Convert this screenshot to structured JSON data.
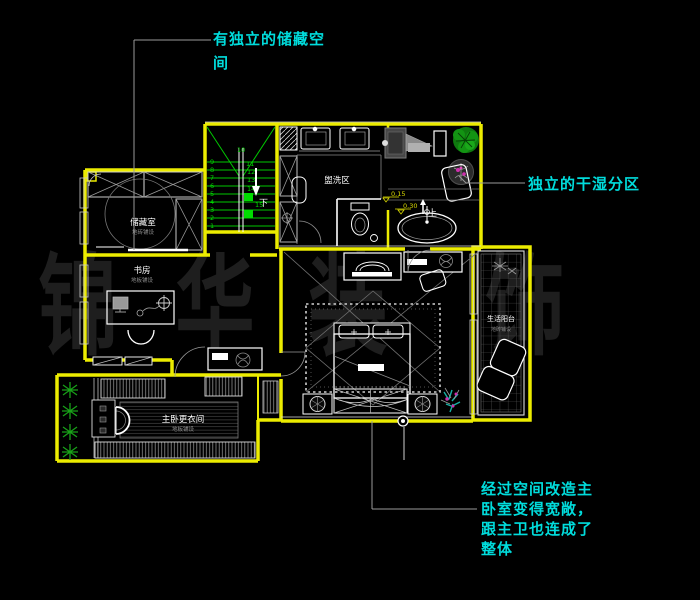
{
  "watermark": {
    "c1": "锦",
    "c2": "华",
    "c3": "装",
    "c4": "饰"
  },
  "annotations": {
    "storage_note_line1": "有独立的储藏空",
    "storage_note_line2": "间",
    "drywet_note": "独立的干湿分区",
    "master_note_line1": "经过空间改造主",
    "master_note_line2": "卧室变得宽敞，",
    "master_note_line3": "跟主卫也连成了",
    "master_note_line4": "整体"
  },
  "rooms": {
    "storage": {
      "name": "储藏室",
      "sub": "地砖铺设"
    },
    "washing": {
      "name": "盥洗区"
    },
    "study": {
      "name": "书房",
      "sub": "地板铺设"
    },
    "closet": {
      "name": "主卧更衣间",
      "sub": "地板铺设"
    },
    "balcony": {
      "name": "生活阳台",
      "sub": "地砖铺设"
    }
  },
  "stairs": {
    "top_number": "10",
    "left_numbers": [
      "9",
      "8",
      "7",
      "6",
      "5",
      "4",
      "3",
      "2",
      "1"
    ],
    "right_numbers": [
      "11",
      "12",
      "13",
      "14",
      "15"
    ],
    "down_label": "下"
  },
  "levels": {
    "level1": "0.15",
    "level2": "0.30",
    "up_label": "上"
  },
  "colors": {
    "wall_yellow": "#ecec00",
    "stair_green": "#00c800",
    "annotation_cyan": "#00dcdc",
    "plant_green": "#18a018",
    "accent_magenta": "#cf2fae",
    "plant_teal": "#17b0a4",
    "watermark_gray": "#1e1e1e",
    "line_white": "#ffffff",
    "line_gray": "#9a9a9a"
  }
}
